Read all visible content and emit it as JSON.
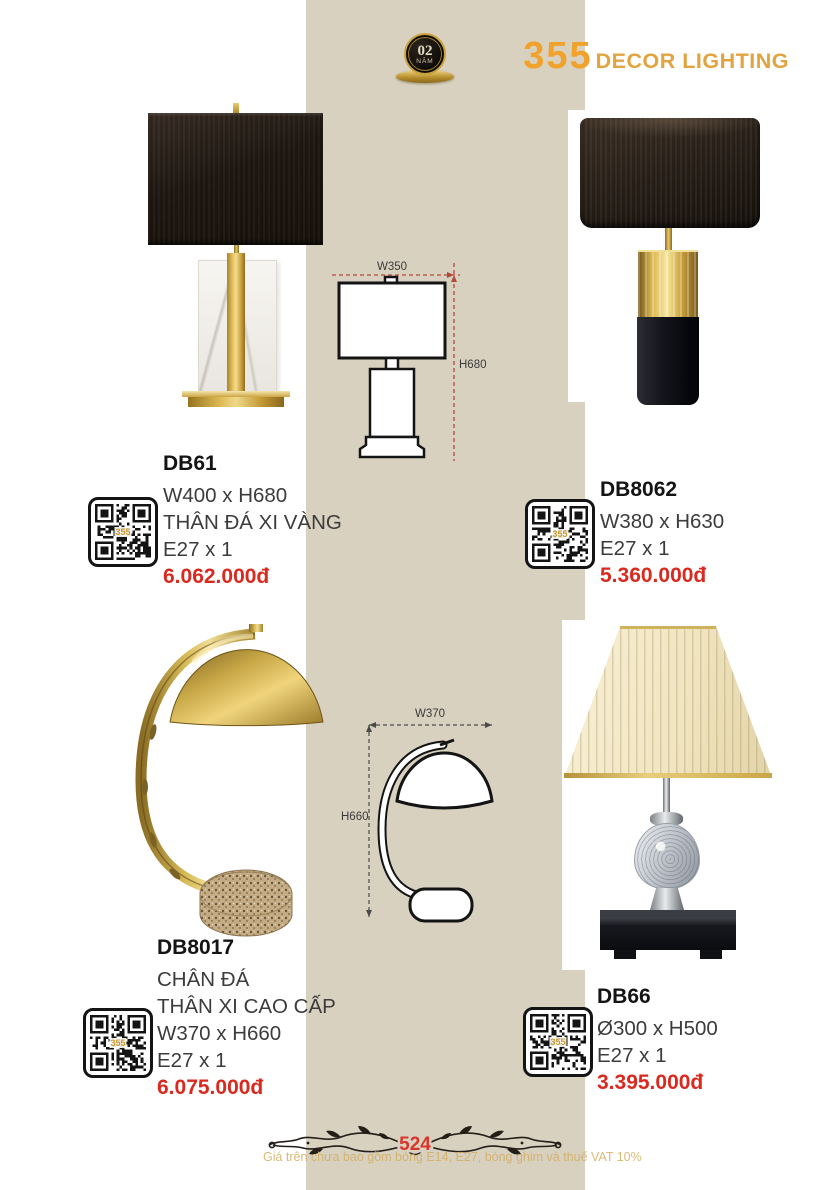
{
  "badge": {
    "number": "02",
    "label": "NĂM"
  },
  "header": {
    "catalog_number": "355",
    "brand": "DECOR LIGHTING"
  },
  "products": [
    {
      "code": "DB61",
      "specs": [
        "W400 x H680",
        "THÂN ĐÁ XI VÀNG",
        "E27 x 1"
      ],
      "price": "6.062.000đ"
    },
    {
      "code": "DB8062",
      "specs": [
        "W380 x H630",
        "E27 x 1"
      ],
      "price": "5.360.000đ"
    },
    {
      "code": "DB8017",
      "specs": [
        "CHÂN ĐÁ",
        "THÂN XI CAO CẤP",
        "W370 x H660",
        "E27 x 1"
      ],
      "price": "6.075.000đ"
    },
    {
      "code": "DB66",
      "specs": [
        "Ø300 x H500",
        "E27 x 1"
      ],
      "price": "3.395.000đ"
    }
  ],
  "diagrams": [
    {
      "width_label": "W350",
      "height_label": "H680"
    },
    {
      "width_label": "W370",
      "height_label": "H660"
    }
  ],
  "qr": {
    "label": "355"
  },
  "footer": {
    "page_number": "524",
    "disclaimer": "Giá trên chưa bao gồm bóng E14, E27, bóng ghim và thuế VAT 10%"
  },
  "colors": {
    "accent_gold": "#f1a22b",
    "price_red": "#da291f",
    "strip_beige": "#d8d1c0"
  }
}
